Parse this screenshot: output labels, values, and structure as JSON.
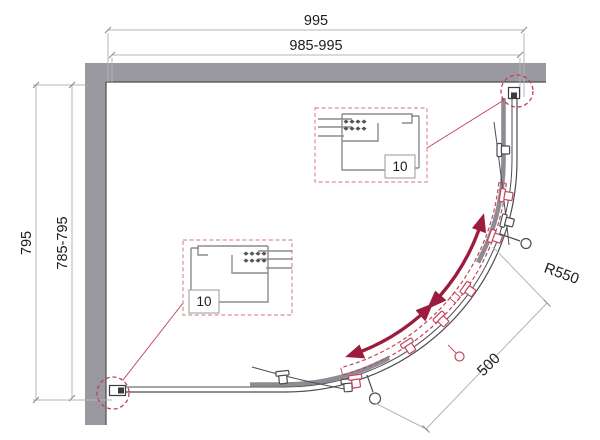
{
  "diagram": {
    "kind": "shower-enclosure-plan-technical-drawing",
    "dimensions": {
      "width_nominal": "995",
      "width_range": "985-995",
      "depth_nominal": "795",
      "depth_range": "785-795",
      "radius": "R550",
      "opening": "500"
    },
    "details": {
      "top": {
        "label": "10"
      },
      "bottom": {
        "label": "10"
      }
    },
    "colors": {
      "background": "#ffffff",
      "wall": "#9a99a0",
      "line_dark": "#4c4c52",
      "line_mid": "#8b8b91",
      "door_panel": "#8c8c92",
      "door_open_red": "#c2475f",
      "accent_red": "#c03f5a",
      "detail_box_red": "#dd9090",
      "arrow_red": "#9d1c3d",
      "dim_line": "#b4b4b8",
      "text": "#1c1c20"
    }
  }
}
